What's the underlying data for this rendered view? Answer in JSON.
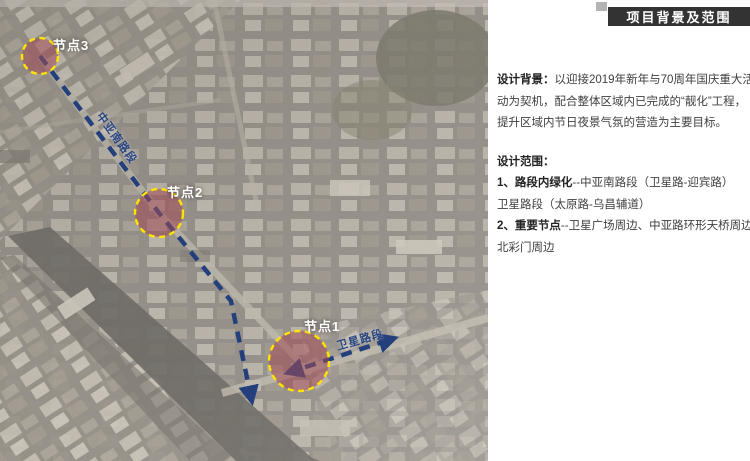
{
  "slide": {
    "title": "项目背景及范围"
  },
  "panel": {
    "background": {
      "lines": [
        {
          "lead": "设计背景：",
          "text": "以迎接2019年新年与70周年国庆重大活"
        },
        {
          "lead": "",
          "text": "动为契机，配合整体区域内已完成的“靓化”工程，"
        },
        {
          "lead": "",
          "text": "提升区域内节日夜景气氛的营造为主要目标。"
        }
      ]
    },
    "scope": {
      "heading": "设计范围：",
      "lines": [
        {
          "lead": "1、路段内绿化",
          "text": "--中亚南路段（卫星路-迎宾路）"
        },
        {
          "lead": "",
          "text": "卫星路段（太原路-乌昌辅道）"
        },
        {
          "lead": "2、重要节点",
          "text": "--卫星广场周边、中亚路环形天桥周边、"
        },
        {
          "lead": "",
          "text": "北彩门周边"
        }
      ]
    }
  },
  "map": {
    "nodes": [
      {
        "label": "节点1"
      },
      {
        "label": "节点2"
      },
      {
        "label": "节点3"
      }
    ],
    "road_labels": [
      {
        "text": "中亚南路段"
      },
      {
        "text": "卫星路段"
      }
    ],
    "colors": {
      "node_fill": "#a04a56",
      "node_ring": "#ffe400",
      "route": "#24407c",
      "title_bar_bg": "#333333",
      "title_text": "#ffffff"
    }
  }
}
